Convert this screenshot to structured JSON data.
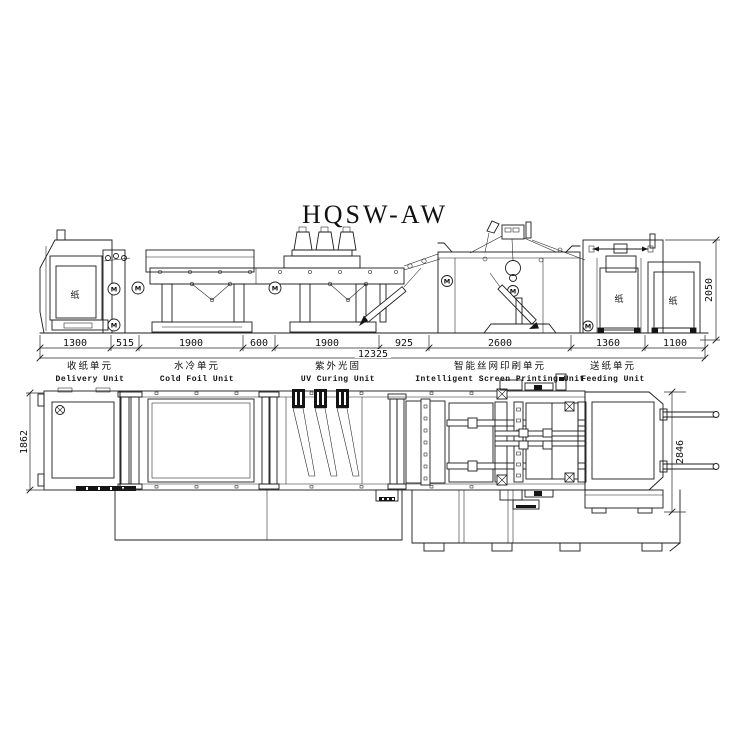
{
  "title": "HQSW-AW",
  "glyphs": {
    "paper": "纸",
    "motor": "M"
  },
  "elevation": {
    "dims": [
      "1300",
      "515",
      "1900",
      "600",
      "1900",
      "925",
      "2600",
      "1360",
      "1100"
    ],
    "total": "12325",
    "height": "2050"
  },
  "plan": {
    "left_width": "1862",
    "right_width": "2846"
  },
  "units": [
    {
      "zh": "收纸单元",
      "en": "Delivery Unit"
    },
    {
      "zh": "水冷单元",
      "en": "Cold Foil Unit"
    },
    {
      "zh": "紫外光固",
      "en": "UV Curing Unit"
    },
    {
      "zh": "智能丝网印刷单元",
      "en": "Intelligent Screen Printing Unit"
    },
    {
      "zh": "送纸单元",
      "en": "Feeding Unit"
    }
  ]
}
